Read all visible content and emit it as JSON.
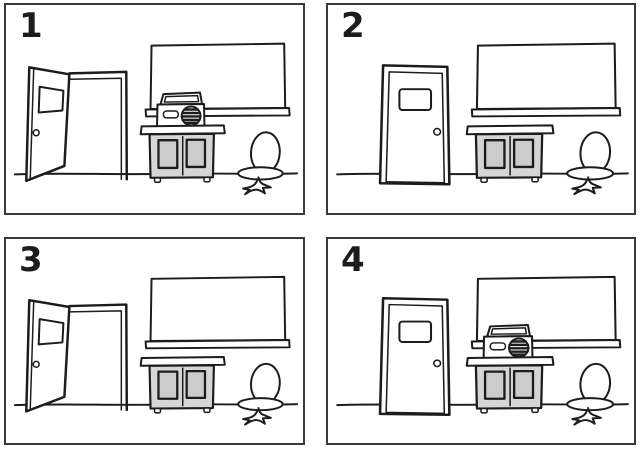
{
  "figure": {
    "kind": "hand-drawn four-panel classroom picture set",
    "ink_color": "#1c1c1c",
    "paper_color": "#ffffff",
    "cabinet_fill": "#d6d6d6",
    "cabinet_panel_fill": "#cccccc",
    "panel_border_color": "#3a3a3a"
  },
  "panels": [
    {
      "number": "1",
      "door_state": "open",
      "tape_player_on_cabinet": true
    },
    {
      "number": "2",
      "door_state": "closed",
      "tape_player_on_cabinet": false
    },
    {
      "number": "3",
      "door_state": "open",
      "tape_player_on_cabinet": false
    },
    {
      "number": "4",
      "door_state": "closed",
      "tape_player_on_cabinet": true
    }
  ],
  "scene_objects": [
    "door",
    "door-window",
    "doorknob",
    "chalkboard",
    "chalk-tray",
    "tape-player",
    "cabinet",
    "swivel-chair",
    "floor-line"
  ]
}
